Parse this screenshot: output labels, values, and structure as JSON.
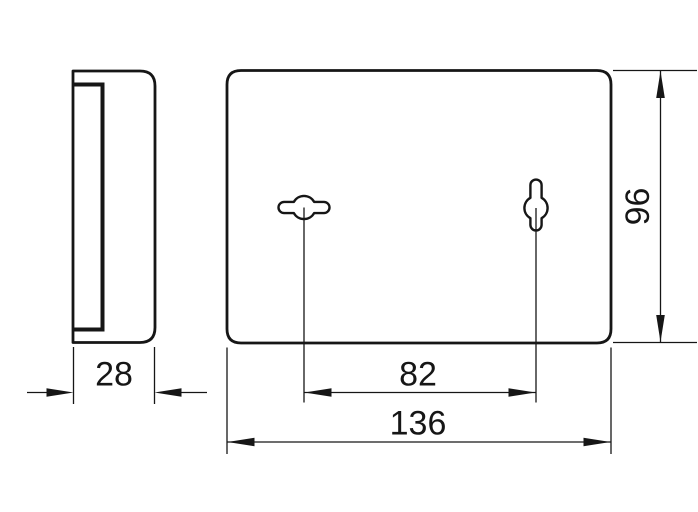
{
  "drawing": {
    "description": "technical-dimension-drawing-wall-plate",
    "background_color": "#ffffff",
    "line_color": "#161616",
    "views": {
      "side_profile": {
        "dimensions": {
          "depth": {
            "value": "28"
          }
        }
      },
      "front": {
        "features": [
          "keyhole-slot-horizontal",
          "keyhole-slot-vertical"
        ],
        "dimensions": {
          "keyhole_spacing": {
            "value": "82"
          },
          "width": {
            "value": "136"
          },
          "height": {
            "value": "96"
          }
        }
      }
    }
  }
}
